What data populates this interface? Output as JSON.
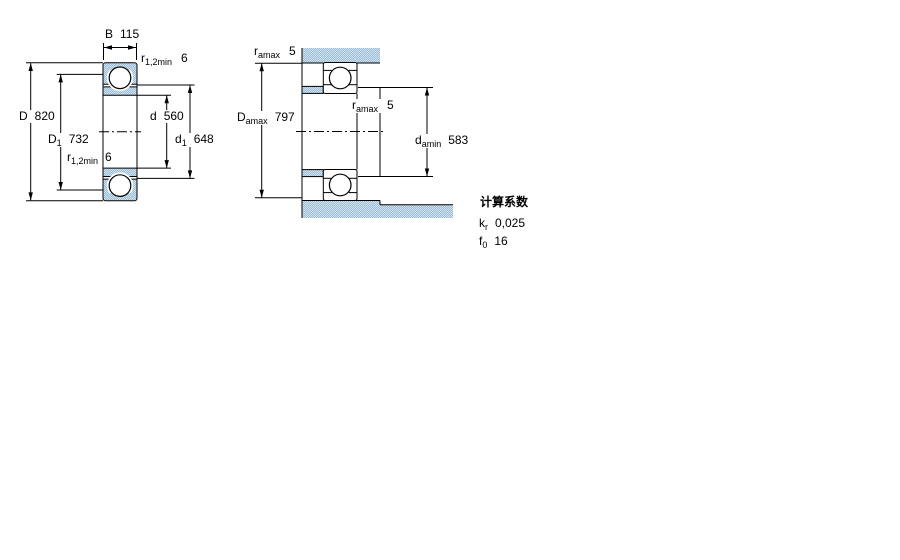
{
  "drawing": {
    "title": "bearing-dimension-drawing",
    "colors": {
      "hatch_dark": "#9dbdd6",
      "hatch_light": "#cfe2ee",
      "line": "#000000",
      "background": "#ffffff"
    },
    "left_diagram": {
      "name": "bearing-cross-section",
      "labels": {
        "width": {
          "base": "B",
          "value": "115"
        },
        "fillet_top": {
          "base": "r",
          "sub": "1,2min",
          "value": "6"
        },
        "outer_diameter": {
          "base": "D",
          "value": "820"
        },
        "shoulder_outer": {
          "base": "D",
          "sub": "1",
          "value": "732"
        },
        "bore_diameter": {
          "base": "d",
          "value": "560"
        },
        "shoulder_inner": {
          "base": "d",
          "sub": "1",
          "value": "648"
        },
        "fillet_bottom": {
          "base": "r",
          "sub": "1,2min",
          "value": "6"
        }
      }
    },
    "right_diagram": {
      "name": "abutment-and-fillet-dimensions",
      "labels": {
        "fillet_housing": {
          "base": "r",
          "sub": "amax",
          "value": "5"
        },
        "housing_diameter": {
          "base": "D",
          "sub": "amax",
          "value": "797"
        },
        "fillet_shaft": {
          "base": "r",
          "sub": "amax",
          "value": "5"
        },
        "shaft_diameter": {
          "base": "d",
          "sub": "amin",
          "value": "583"
        }
      }
    },
    "calculation_factors": {
      "title": "计算系数",
      "rows": [
        {
          "base": "k",
          "sub": "r",
          "value": "0,025"
        },
        {
          "base": "f",
          "sub": "0",
          "value": "16"
        }
      ]
    }
  }
}
